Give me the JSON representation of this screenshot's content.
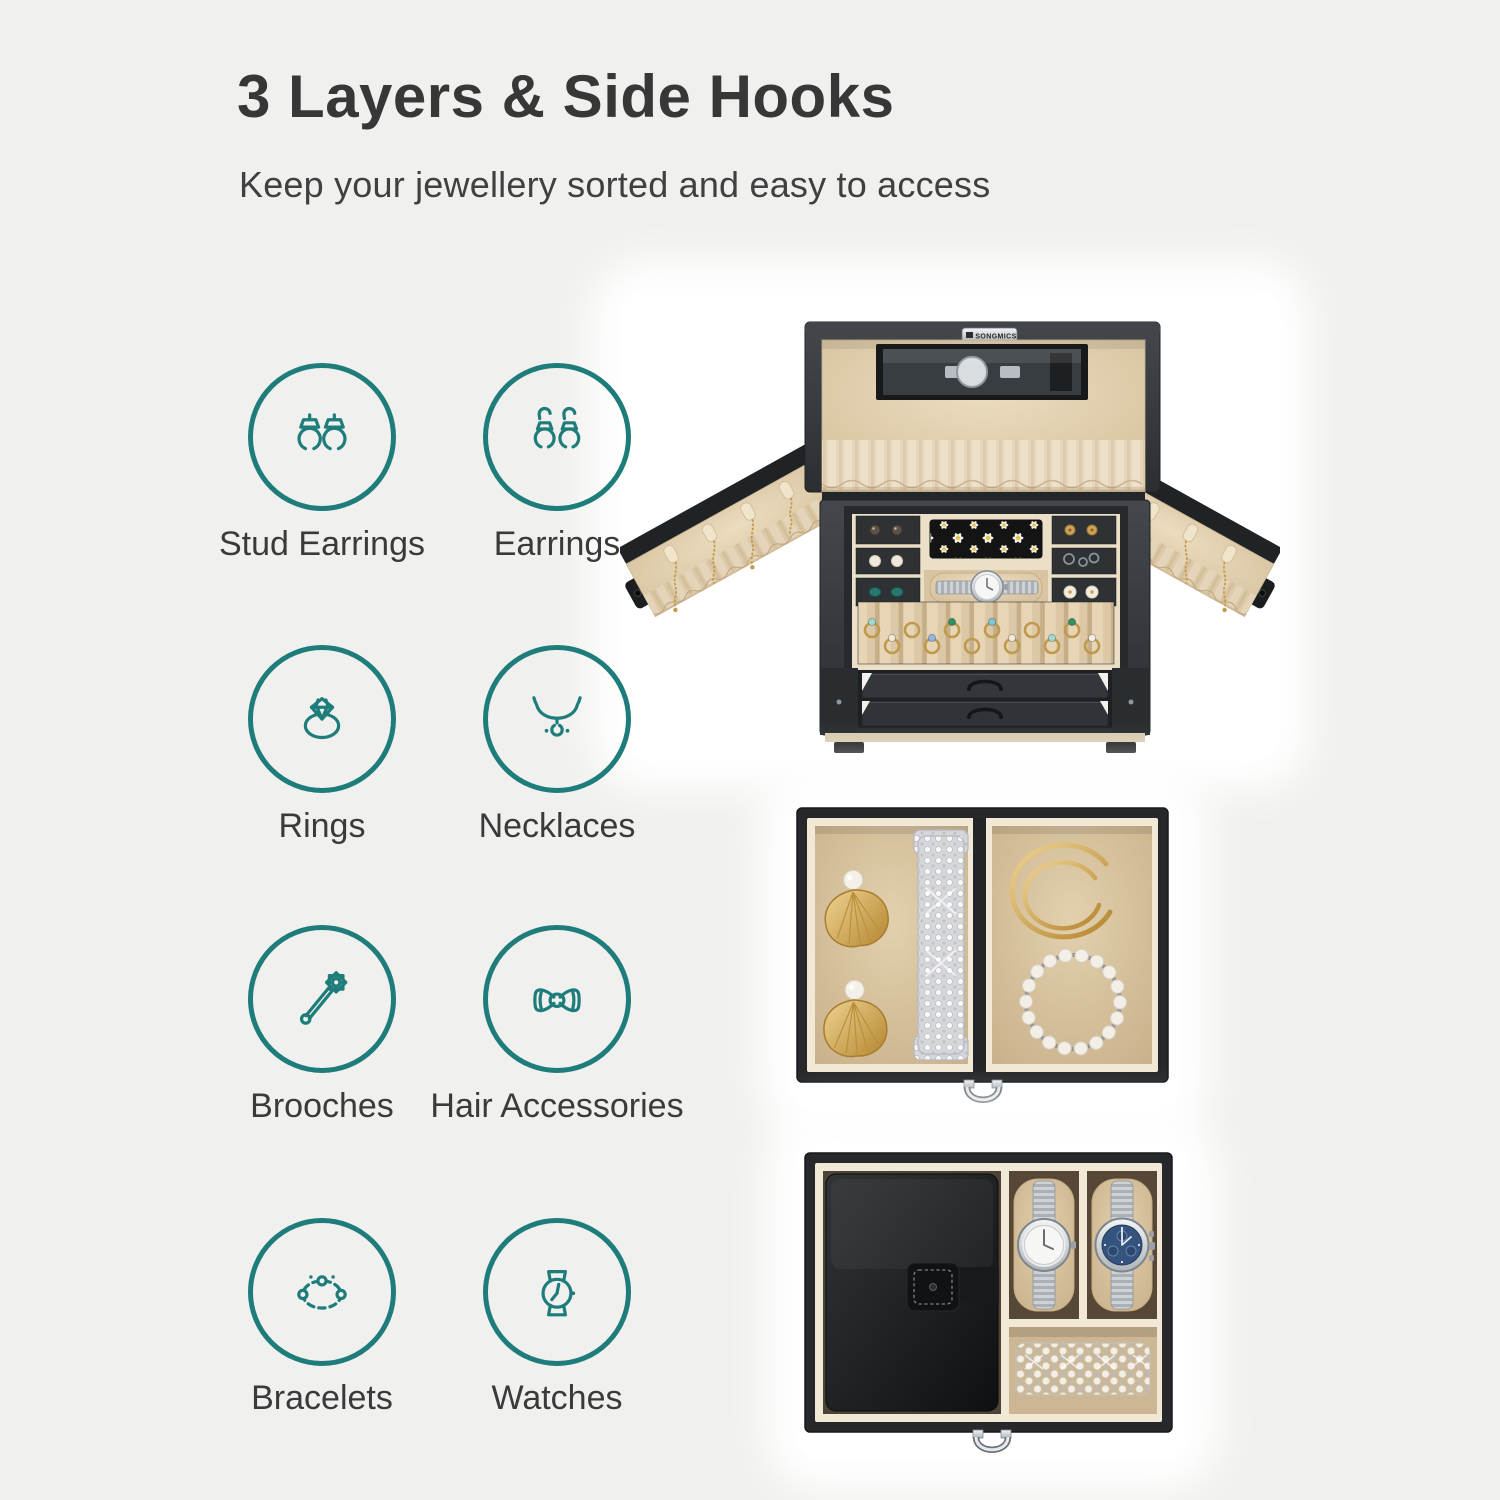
{
  "page": {
    "background_color": "#f0f0ee",
    "accent_color": "#1e7d7b"
  },
  "header": {
    "title": "3 Layers & Side Hooks",
    "subtitle": "Keep your jewellery sorted and easy to access"
  },
  "features": [
    {
      "id": "stud-earrings",
      "label": "Stud Earrings"
    },
    {
      "id": "earrings",
      "label": "Earrings"
    },
    {
      "id": "rings",
      "label": "Rings"
    },
    {
      "id": "necklaces",
      "label": "Necklaces"
    },
    {
      "id": "brooches",
      "label": "Brooches"
    },
    {
      "id": "hair-accessories",
      "label": "Hair Accessories"
    },
    {
      "id": "bracelets",
      "label": "Bracelets"
    },
    {
      "id": "watches",
      "label": "Watches"
    }
  ],
  "photos": {
    "open_box": {
      "brand": "SONGMICS"
    }
  }
}
